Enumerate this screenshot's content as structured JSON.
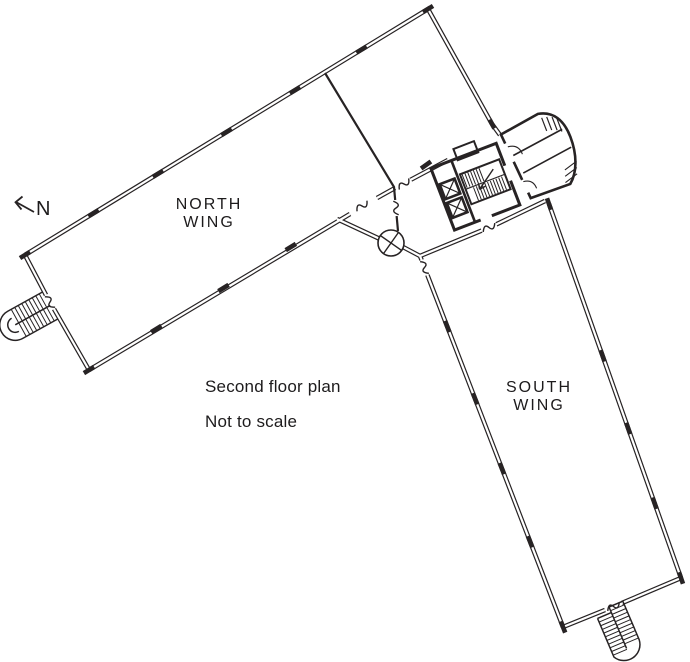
{
  "labels": {
    "north_wing": {
      "line1": "NORTH",
      "line2": "WING"
    },
    "south_wing": {
      "line1": "SOUTH",
      "line2": "WING"
    },
    "caption_line1": "Second floor plan",
    "caption_line2": "Not to scale",
    "north_arrow": "N"
  },
  "colors": {
    "line": "#272324",
    "background": "#ffffff"
  },
  "drawing": {
    "type": "architectural-floor-plan",
    "features": [
      "north-wing",
      "south-wing",
      "elevator-core",
      "scissor-stair",
      "entrance-vestibule",
      "northwest-exterior-stair",
      "southeast-exterior-stair",
      "junction-column-symbol",
      "north-arrow"
    ]
  }
}
